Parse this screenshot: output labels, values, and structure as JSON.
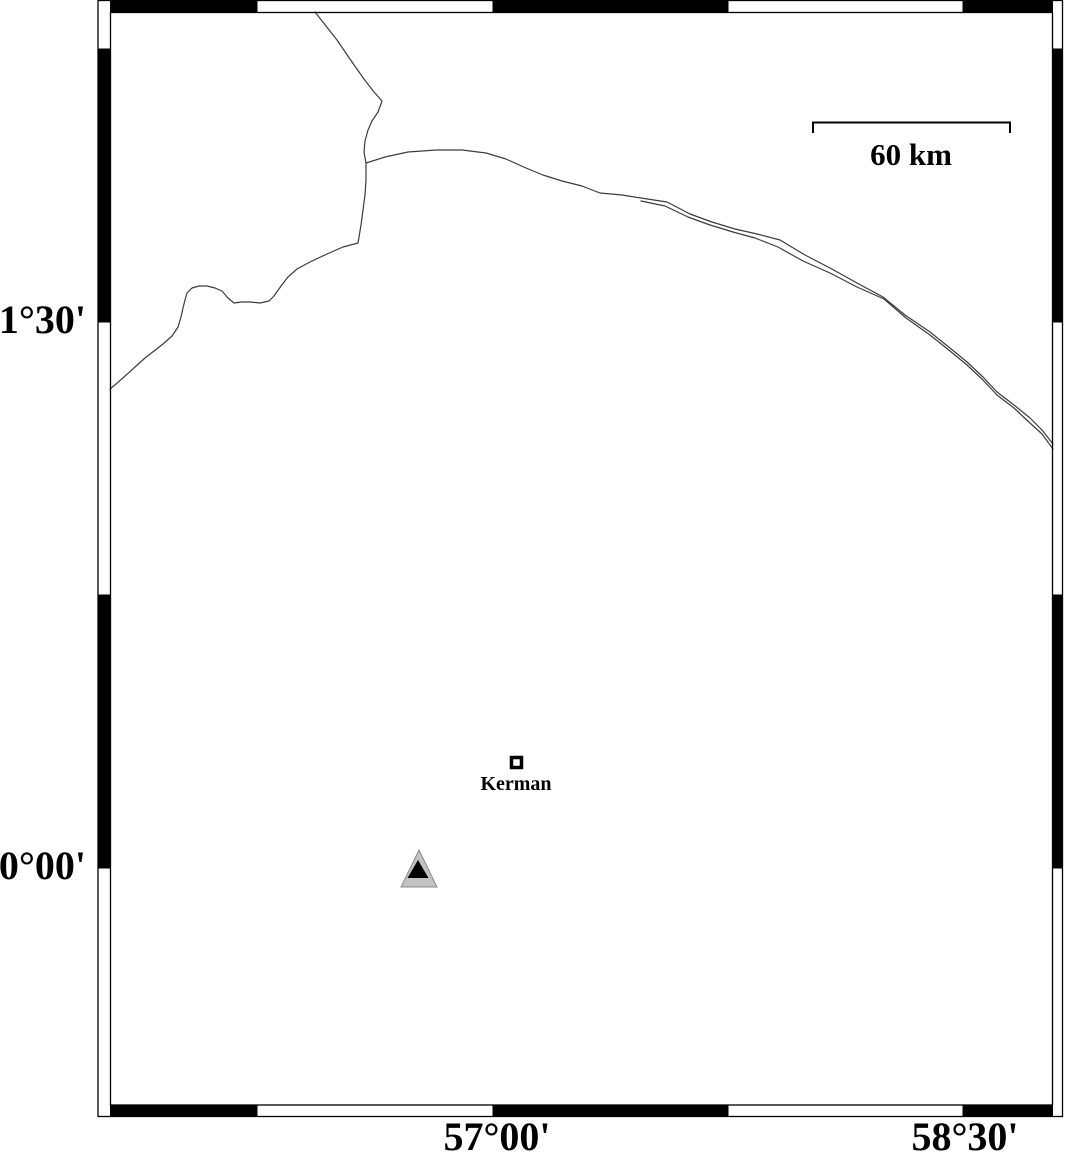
{
  "map": {
    "lat_ticks": [
      {
        "label": "31°30'"
      },
      {
        "label": "30°00'"
      }
    ],
    "lon_ticks": [
      {
        "label": "57°00'"
      },
      {
        "label": "58°30'"
      }
    ],
    "scale_bar": {
      "label": "60 km"
    },
    "city": {
      "label": "Kerman"
    },
    "station": {
      "symbol": "triangle"
    },
    "colors": {
      "road_line": "#3c3c3c",
      "frame": "#000000",
      "station_fill": "#c2c2c2",
      "station_core": "#000000",
      "background": "#ffffff"
    },
    "paths": {
      "road_north": "M 315,12 L 337,40 L 352,62 L 364,79 L 374,92 L 382,101 L 378,112 L 372,121 L 368,130 L 365,141 L 364,152 L 366,163 L 366,180 L 365,195 L 363,210 L 361,225 L 358,243 L 343,247 L 327,254 L 310,262 L 297,269 L 288,277 L 281,286 L 274,296 L 269,301 L 260,303 L 250,302 L 241,302 L 234,303 L 228,298 L 222,291 L 215,288 L 207,286 L 199,286 L 192,288 L 187,293 L 185,300 L 183,308 L 181,317 L 178,327 L 172,336 L 163,344 L 154,351 L 145,358 L 135,367 L 124,377 L 116,384 L 110,389",
      "road_east_upper": "M 366,163 L 385,157 L 408,152 L 436,150 L 462,150 L 486,153 L 506,159 L 526,168 L 543,175 L 562,181 L 582,186 L 600,193 L 622,195 L 641,198 L 667,202 L 690,214 L 712,222 L 735,229 L 757,234 L 780,240 L 805,255 L 830,268 L 857,283 L 883,297 L 905,315 L 930,332 L 950,348 L 967,362 L 983,377 L 997,392 L 1014,405 L 1030,418 L 1042,430 L 1053,444",
      "road_east_lower": "M 641,201 L 665,206 L 688,217 L 710,225 L 733,232 L 755,238 L 778,247 L 803,261 L 830,273 L 857,287 L 884,299 L 906,318 L 930,335 L 950,351 L 967,365 L 983,380 L 997,395 L 1014,408 L 1030,423 L 1042,434 L 1053,449"
    }
  }
}
